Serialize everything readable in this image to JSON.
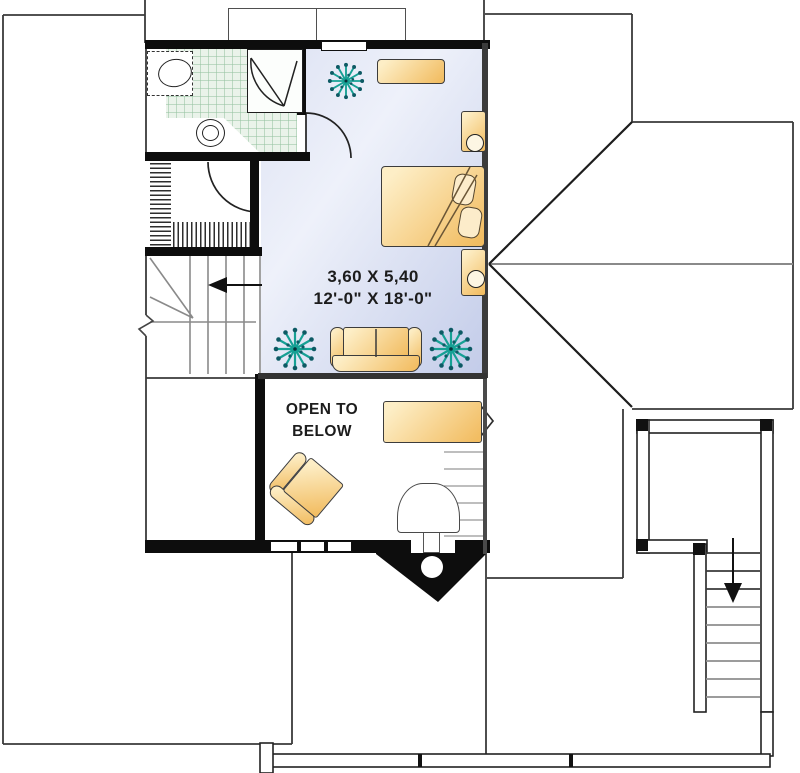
{
  "labels": {
    "dimensions_metric": "3,60 X 5,40",
    "dimensions_imperial": "12'-0\" X 18'-0\"",
    "open_to_below_line1": "OPEN TO",
    "open_to_below_line2": "BELOW"
  },
  "arrows": {
    "interior_stair_direction": "left",
    "exterior_stair_direction": "down"
  },
  "symbols": [
    "bed",
    "pillows",
    "dresser",
    "nightstand-with-lamp",
    "sofa",
    "armchair",
    "plant",
    "desk",
    "chair",
    "toilet",
    "sink-vanity",
    "shower-stall",
    "closet-hanging-rod",
    "interior-staircase",
    "exterior-deck-staircase",
    "roof-ridge-lines",
    "bay-window"
  ],
  "colors": {
    "wall": "#0d0d0d",
    "line": "#3a3a3a",
    "bedroom_dark": "#c3cce9",
    "tile": "#eaf3ea",
    "furn_light": "#fdeec6",
    "furn_dark": "#f2bd62",
    "plant": "#16a094",
    "plant_dot": "#0d5a64",
    "text": "#1c1c1c"
  }
}
